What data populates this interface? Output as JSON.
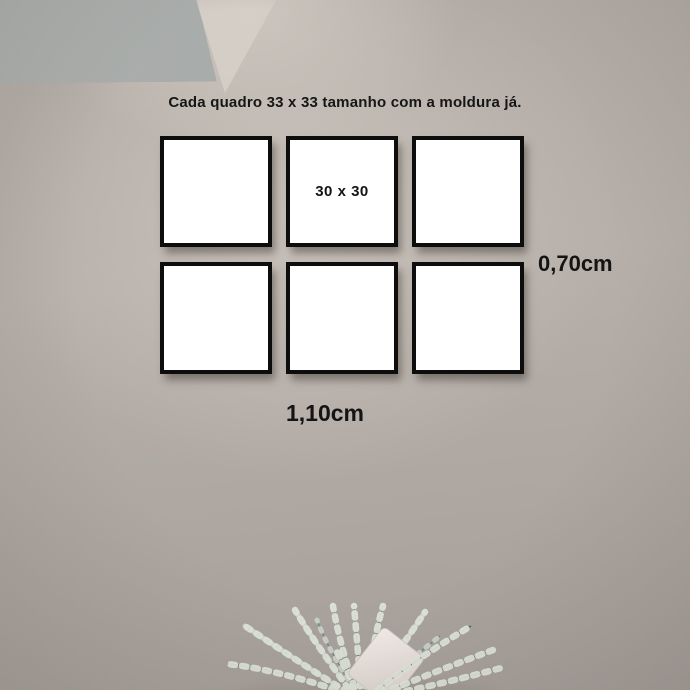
{
  "annotation": {
    "title": "Cada quadro 33 x 33 tamanho com a moldura já.",
    "frame_inner_size": "30 x 30",
    "height_label": "0,70cm",
    "width_label": "1,10cm"
  },
  "frames": {
    "rows": 2,
    "columns": 3,
    "count": 6
  },
  "colors": {
    "wall": "#b4ada7",
    "wall_highlight": "#c9c2bb",
    "ceiling_shadow": "#a2a6a5",
    "ceiling_light": "#d7d0c8",
    "frame_border": "#0d0d0d",
    "frame_fill": "#ffffff",
    "text": "#141414",
    "plant_stem": "#49524a",
    "plant_stem_blue": "#6d7f86",
    "plant_catkin": "#dfe5da",
    "tag": "#ece4df"
  },
  "icons": {
    "picture-frame": "bordered-square",
    "pussy-willow-plant": "svg-branches-with-catkins",
    "gift-tag": "rotated-rounded-rect"
  }
}
